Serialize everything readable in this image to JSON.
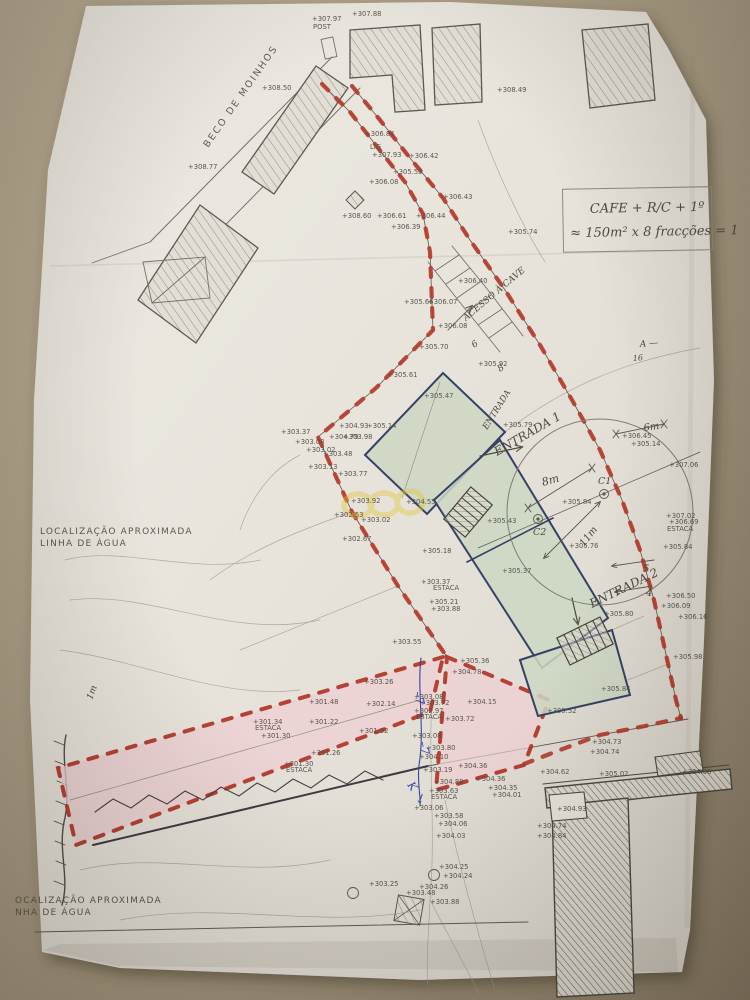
{
  "photo": {
    "desk_color": "#a89b84",
    "paper_color": "#e9e6e0"
  },
  "colors": {
    "boundary_red": "#b23226",
    "pink_fill": "#f0d0d6",
    "green_fill": "#ccd8c6",
    "navy": "#2c3a63",
    "line_gray": "#6f6d67",
    "pencil": "#45423c",
    "blue_ink": "#2b3f9e",
    "yellow_mark": "#e2c430"
  },
  "notes": {
    "cafe_line1": "CAFE + R/C + 1º",
    "cafe_line2": "≈ 150m² x 8 fracções = 1",
    "street": "BECO DE MOINHOS",
    "water_top_line1": "LOCALIZAÇÃO APROXIMADA",
    "water_top_line2": "LINHA DE ÁGUA",
    "water_bottom_line1": "OCALIZAÇÃO APROXIMADA",
    "water_bottom_line2": "NHA DE ÁGUA"
  },
  "handwritten": [
    {
      "t": "ENTRADA",
      "x": 487,
      "y": 430,
      "r": -58,
      "s": 8.5,
      "c": "pencil"
    },
    {
      "t": "ENTRADA 1",
      "x": 497,
      "y": 456,
      "r": -30,
      "s": 12,
      "c": "pencil"
    },
    {
      "t": "ENTRADA 2",
      "x": 592,
      "y": 608,
      "r": -26,
      "s": 12,
      "c": "pencil"
    },
    {
      "t": "ACESSO À CAVE",
      "x": 466,
      "y": 321,
      "r": -40,
      "s": 9,
      "c": "pencil"
    },
    {
      "t": "8m",
      "x": 543,
      "y": 486,
      "r": -16,
      "s": 11,
      "c": "pencil"
    },
    {
      "t": "6m",
      "x": 644,
      "y": 431,
      "r": -8,
      "s": 10,
      "c": "pencil"
    },
    {
      "t": "C1",
      "x": 598,
      "y": 484,
      "r": 0,
      "s": 9.5,
      "c": "pencil"
    },
    {
      "t": "C2",
      "x": 533,
      "y": 535,
      "r": 0,
      "s": 9.5,
      "c": "pencil"
    },
    {
      "t": "11m",
      "x": 584,
      "y": 547,
      "r": -52,
      "s": 10,
      "c": "pencil"
    },
    {
      "t": "5",
      "x": 643,
      "y": 572,
      "r": 0,
      "s": 10,
      "c": "pencil"
    },
    {
      "t": "4",
      "x": 646,
      "y": 596,
      "r": 0,
      "s": 10,
      "c": "pencil"
    },
    {
      "t": "6",
      "x": 474,
      "y": 348,
      "r": -35,
      "s": 9,
      "c": "pencil"
    },
    {
      "t": "8",
      "x": 500,
      "y": 372,
      "r": -35,
      "s": 9,
      "c": "pencil"
    },
    {
      "t": "A —",
      "x": 640,
      "y": 347,
      "r": -5,
      "s": 9,
      "c": "pencil"
    },
    {
      "t": "16",
      "x": 633,
      "y": 361,
      "r": -5,
      "s": 8,
      "c": "pencil"
    },
    {
      "t": "1m",
      "x": 92,
      "y": 700,
      "r": -70,
      "s": 9,
      "c": "pencil"
    },
    {
      "t": "–7",
      "x": 414,
      "y": 692,
      "r": 80,
      "s": 12,
      "c": "blue"
    },
    {
      "t": "–7",
      "x": 419,
      "y": 742,
      "r": 80,
      "s": 12,
      "c": "blue"
    },
    {
      "t": "K",
      "x": 407,
      "y": 785,
      "r": 55,
      "s": 11,
      "c": "blue"
    },
    {
      "t": "↓",
      "x": 414,
      "y": 801,
      "r": 20,
      "s": 13,
      "c": "blue"
    }
  ],
  "survey_points": [
    {
      "x": 312,
      "y": 21,
      "t": "+307.97"
    },
    {
      "x": 313,
      "y": 29,
      "t": "POST"
    },
    {
      "x": 352,
      "y": 16,
      "t": "+307.88"
    },
    {
      "x": 262,
      "y": 90,
      "t": "+308.50"
    },
    {
      "x": 188,
      "y": 169,
      "t": "+308.77"
    },
    {
      "x": 497,
      "y": 92,
      "t": "+308.49"
    },
    {
      "x": 365,
      "y": 136,
      "t": "+306.84"
    },
    {
      "x": 370,
      "y": 149,
      "t": "LIG"
    },
    {
      "x": 372,
      "y": 157,
      "t": "+307.93"
    },
    {
      "x": 409,
      "y": 158,
      "t": "+306.42"
    },
    {
      "x": 393,
      "y": 174,
      "t": "+305.53"
    },
    {
      "x": 369,
      "y": 184,
      "t": "+306.08"
    },
    {
      "x": 443,
      "y": 199,
      "t": "+306.43"
    },
    {
      "x": 342,
      "y": 218,
      "t": "+308.60"
    },
    {
      "x": 377,
      "y": 218,
      "t": "+306.61"
    },
    {
      "x": 416,
      "y": 218,
      "t": "+306.44"
    },
    {
      "x": 391,
      "y": 229,
      "t": "+306.39"
    },
    {
      "x": 508,
      "y": 234,
      "t": "+305.74"
    },
    {
      "x": 458,
      "y": 283,
      "t": "+306.40"
    },
    {
      "x": 404,
      "y": 304,
      "t": "+305.66"
    },
    {
      "x": 428,
      "y": 304,
      "t": "+306.07"
    },
    {
      "x": 438,
      "y": 328,
      "t": "+306.08"
    },
    {
      "x": 419,
      "y": 349,
      "t": "+305.70"
    },
    {
      "x": 478,
      "y": 366,
      "t": "+305.92"
    },
    {
      "x": 281,
      "y": 434,
      "t": "+303.37"
    },
    {
      "x": 339,
      "y": 428,
      "t": "+304.93"
    },
    {
      "x": 367,
      "y": 428,
      "t": "+305.14"
    },
    {
      "x": 329,
      "y": 439,
      "t": "+304.79"
    },
    {
      "x": 343,
      "y": 439,
      "t": "+303.98"
    },
    {
      "x": 295,
      "y": 444,
      "t": "+303.08"
    },
    {
      "x": 306,
      "y": 452,
      "t": "+303.02"
    },
    {
      "x": 323,
      "y": 456,
      "t": "+303.48"
    },
    {
      "x": 308,
      "y": 469,
      "t": "+303.13"
    },
    {
      "x": 338,
      "y": 476,
      "t": "+303.77"
    },
    {
      "x": 351,
      "y": 503,
      "t": "+303.92"
    },
    {
      "x": 406,
      "y": 504,
      "t": "+304.55"
    },
    {
      "x": 334,
      "y": 517,
      "t": "+302.53"
    },
    {
      "x": 361,
      "y": 522,
      "t": "+303.02"
    },
    {
      "x": 342,
      "y": 541,
      "t": "+302.67"
    },
    {
      "x": 388,
      "y": 377,
      "t": "+305.61"
    },
    {
      "x": 424,
      "y": 398,
      "t": "+305.47"
    },
    {
      "x": 503,
      "y": 427,
      "t": "+305.79"
    },
    {
      "x": 487,
      "y": 523,
      "t": "+305.43"
    },
    {
      "x": 502,
      "y": 573,
      "t": "+305.37"
    },
    {
      "x": 422,
      "y": 553,
      "t": "+305.18"
    },
    {
      "x": 421,
      "y": 584,
      "t": "+303.37"
    },
    {
      "x": 433,
      "y": 590,
      "t": "ESTACA"
    },
    {
      "x": 429,
      "y": 604,
      "t": "+305.21"
    },
    {
      "x": 431,
      "y": 611,
      "t": "+303.88"
    },
    {
      "x": 604,
      "y": 616,
      "t": "+305.80"
    },
    {
      "x": 601,
      "y": 691,
      "t": "+305.84"
    },
    {
      "x": 547,
      "y": 713,
      "t": "+305.52"
    },
    {
      "x": 562,
      "y": 504,
      "t": "+305.84"
    },
    {
      "x": 569,
      "y": 548,
      "t": "+305.76"
    },
    {
      "x": 669,
      "y": 467,
      "t": "+307.06"
    },
    {
      "x": 622,
      "y": 438,
      "t": "+306.45"
    },
    {
      "x": 631,
      "y": 446,
      "t": "+305.14"
    },
    {
      "x": 666,
      "y": 518,
      "t": "+307.02"
    },
    {
      "x": 669,
      "y": 524,
      "t": "+306.69"
    },
    {
      "x": 667,
      "y": 531,
      "t": "ESTACA"
    },
    {
      "x": 663,
      "y": 549,
      "t": "+305.84"
    },
    {
      "x": 666,
      "y": 598,
      "t": "+306.50"
    },
    {
      "x": 661,
      "y": 608,
      "t": "+306.09"
    },
    {
      "x": 678,
      "y": 619,
      "t": "+306.16"
    },
    {
      "x": 673,
      "y": 659,
      "t": "+305.98"
    },
    {
      "x": 392,
      "y": 644,
      "t": "+303.55"
    },
    {
      "x": 460,
      "y": 663,
      "t": "+305.36"
    },
    {
      "x": 452,
      "y": 674,
      "t": "+304.78"
    },
    {
      "x": 414,
      "y": 699,
      "t": "+303.08"
    },
    {
      "x": 420,
      "y": 705,
      "t": "+303.72"
    },
    {
      "x": 414,
      "y": 713,
      "t": "+302.97"
    },
    {
      "x": 416,
      "y": 719,
      "t": "ESTACA"
    },
    {
      "x": 445,
      "y": 721,
      "t": "+303.72"
    },
    {
      "x": 467,
      "y": 704,
      "t": "+304.15"
    },
    {
      "x": 412,
      "y": 738,
      "t": "+303.08"
    },
    {
      "x": 426,
      "y": 750,
      "t": "+303.80"
    },
    {
      "x": 419,
      "y": 759,
      "t": "+304.10"
    },
    {
      "x": 423,
      "y": 772,
      "t": "+303.19"
    },
    {
      "x": 458,
      "y": 768,
      "t": "+304.36"
    },
    {
      "x": 476,
      "y": 781,
      "t": "+304.36"
    },
    {
      "x": 488,
      "y": 790,
      "t": "+304.35"
    },
    {
      "x": 492,
      "y": 797,
      "t": "+304.01"
    },
    {
      "x": 434,
      "y": 784,
      "t": "+304.88"
    },
    {
      "x": 429,
      "y": 793,
      "t": "+303.63"
    },
    {
      "x": 431,
      "y": 799,
      "t": "ESTACA"
    },
    {
      "x": 414,
      "y": 810,
      "t": "+303.06"
    },
    {
      "x": 434,
      "y": 818,
      "t": "+303.58"
    },
    {
      "x": 438,
      "y": 826,
      "t": "+304.06"
    },
    {
      "x": 436,
      "y": 838,
      "t": "+304.03"
    },
    {
      "x": 439,
      "y": 869,
      "t": "+304.25"
    },
    {
      "x": 443,
      "y": 878,
      "t": "+304.24"
    },
    {
      "x": 419,
      "y": 889,
      "t": "+304.26"
    },
    {
      "x": 406,
      "y": 895,
      "t": "+303.48"
    },
    {
      "x": 369,
      "y": 886,
      "t": "+303.25"
    },
    {
      "x": 430,
      "y": 904,
      "t": "+303.88"
    },
    {
      "x": 364,
      "y": 684,
      "t": "+303.26"
    },
    {
      "x": 309,
      "y": 704,
      "t": "+301.48"
    },
    {
      "x": 366,
      "y": 706,
      "t": "+302.14"
    },
    {
      "x": 253,
      "y": 724,
      "t": "+301.34"
    },
    {
      "x": 255,
      "y": 730,
      "t": "ESTACA"
    },
    {
      "x": 309,
      "y": 724,
      "t": "+301.22"
    },
    {
      "x": 359,
      "y": 733,
      "t": "+301.92"
    },
    {
      "x": 261,
      "y": 738,
      "t": "+301.30"
    },
    {
      "x": 311,
      "y": 755,
      "t": "+301.26"
    },
    {
      "x": 284,
      "y": 766,
      "t": "+301.30"
    },
    {
      "x": 286,
      "y": 772,
      "t": "ESTACA"
    },
    {
      "x": 592,
      "y": 744,
      "t": "+304.73"
    },
    {
      "x": 590,
      "y": 754,
      "t": "+304.74"
    },
    {
      "x": 540,
      "y": 774,
      "t": "+304.62"
    },
    {
      "x": 599,
      "y": 776,
      "t": "+305.02"
    },
    {
      "x": 557,
      "y": 811,
      "t": "+304.93"
    },
    {
      "x": 537,
      "y": 828,
      "t": "+304.74"
    },
    {
      "x": 537,
      "y": 838,
      "t": "+304.84"
    },
    {
      "x": 682,
      "y": 774,
      "t": "+304.08"
    }
  ]
}
